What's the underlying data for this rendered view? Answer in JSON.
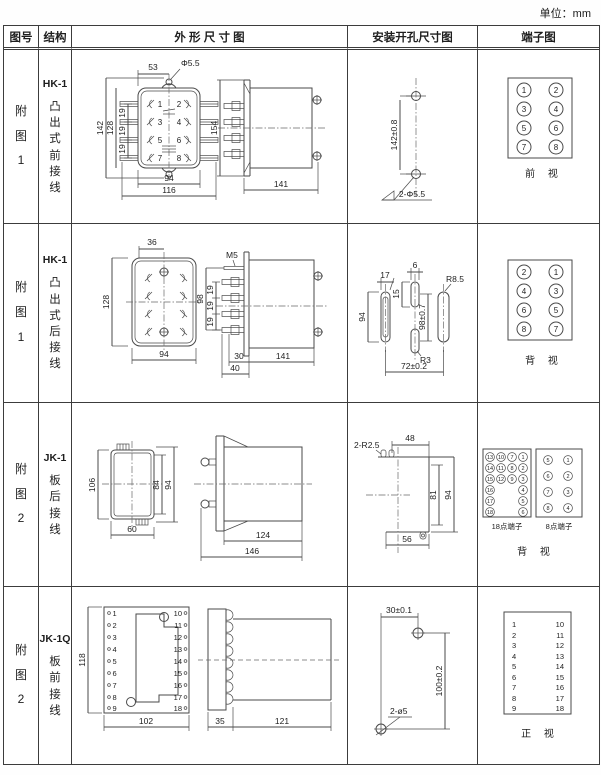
{
  "units_label": "单位：mm",
  "header": {
    "fig": "图号",
    "structure": "结构",
    "outline": "外 形 尺 寸 图",
    "mounting": "安装开孔尺寸图",
    "terminal": "端子图"
  },
  "rows": [
    {
      "figno": "附图1",
      "model": "HK-1",
      "desc": "凸出式前接线",
      "outline": {
        "dim_top": "53",
        "dim_hole": "Φ5.5",
        "dim_h1": "142",
        "dim_h2": "128",
        "p1": "19",
        "p2": "19",
        "p3": "19",
        "dim_w1": "94",
        "dim_w2": "116",
        "n1": "1",
        "n2": "2",
        "n3": "3",
        "n4": "4",
        "n5": "5",
        "n6": "6",
        "n7": "7",
        "n8": "8",
        "side_h": "154",
        "side_d": "141"
      },
      "mounting": {
        "dim_v": "142±0.8",
        "dim_holes": "2-Φ5.5"
      },
      "terminal": {
        "l1": "1",
        "l2": "3",
        "l3": "5",
        "l4": "7",
        "r1": "2",
        "r2": "4",
        "r3": "6",
        "r4": "8",
        "caption": "前 视"
      }
    },
    {
      "figno": "附图1",
      "model": "HK-1",
      "desc": "凸出式后接线",
      "outline": {
        "dim_top": "36",
        "dim_h": "128",
        "dim_w": "94",
        "m5": "M5",
        "side_h": "98",
        "p1": "19",
        "p2": "19",
        "p3": "19",
        "d1": "30",
        "d2": "40",
        "side_d": "141"
      },
      "mounting": {
        "w_slot": "17",
        "w_center": "6",
        "r_corner": "R8.5",
        "h_center": "15",
        "h_slot": "94",
        "dim_v": "98±0.7",
        "r_bottom": "R3",
        "dim_w": "72±0.2"
      },
      "terminal": {
        "l1": "2",
        "l2": "4",
        "l3": "6",
        "l4": "8",
        "r1": "1",
        "r2": "3",
        "r3": "5",
        "r4": "7",
        "caption": "背 视"
      }
    },
    {
      "figno": "附图2",
      "model": "JK-1",
      "desc": "板后接线",
      "outline": {
        "dim_h1": "106",
        "dim_h2": "84",
        "dim_h3": "94",
        "dim_w": "60",
        "side_d1": "124",
        "side_d2": "146"
      },
      "mounting": {
        "r_corner": "2-R2.5",
        "dim_top": "48",
        "dim_h1": "81",
        "dim_h2": "94",
        "dim_w": "56"
      },
      "terminal": {
        "t18_label": "18点端子",
        "t8_label": "8点端子",
        "caption": "背 视",
        "t18_c1": [
          "13",
          "14",
          "15",
          "16",
          "17",
          "18"
        ],
        "t18_c2": [
          "10",
          "11",
          "12"
        ],
        "t18_c3": [
          "7",
          "8",
          "9"
        ],
        "t18_c4": [
          "1",
          "2",
          "3",
          "4",
          "5",
          "6"
        ],
        "t8_l": [
          "5",
          "6",
          "7",
          "8"
        ],
        "t8_r": [
          "1",
          "2",
          "3",
          "4"
        ]
      }
    },
    {
      "figno": "附图2",
      "model": "JK-1Q",
      "desc": "板前接线",
      "outline": {
        "dim_h": "118",
        "dim_w": "102",
        "side_d1": "35",
        "side_d2": "121",
        "left": [
          "1",
          "2",
          "3",
          "4",
          "5",
          "6",
          "7",
          "8",
          "9"
        ],
        "right": [
          "10",
          "11",
          "12",
          "13",
          "14",
          "15",
          "16",
          "17",
          "18"
        ]
      },
      "mounting": {
        "dim_top": "30±0.1",
        "dim_v": "100±0.2",
        "dim_holes": "2-ø5"
      },
      "terminal": {
        "left": [
          "1",
          "2",
          "3",
          "4",
          "5",
          "6",
          "7",
          "8",
          "9"
        ],
        "right": [
          "10",
          "11",
          "12",
          "13",
          "14",
          "15",
          "16",
          "17",
          "18"
        ],
        "caption": "正 视"
      }
    }
  ]
}
